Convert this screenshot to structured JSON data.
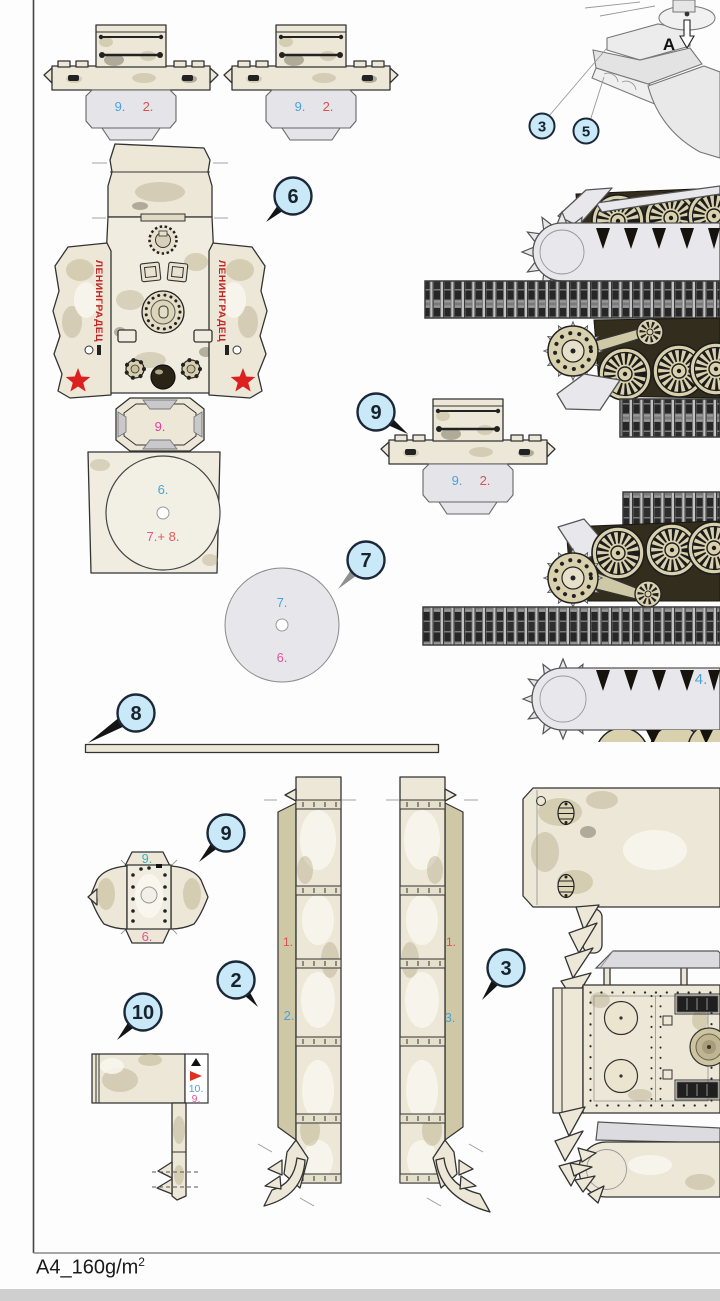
{
  "sheet": {
    "paper_spec": "A4_160g/m",
    "paper_spec_sup": "2"
  },
  "illustration": {
    "step_letter": "A",
    "callout_3": "3",
    "callout_5": "5"
  },
  "callouts": {
    "turret": "6",
    "stowage_mid": "9",
    "turret_ring_disc": "7",
    "axle_strip": "8",
    "hatch_dome": "9",
    "fender_left": "2",
    "fender_right": "3",
    "mudguard": "10"
  },
  "parts": {
    "stowage_box": {
      "label_blue": "9.",
      "label_red": "2."
    },
    "turret": {
      "neck_label": "9.",
      "base_label": "6.",
      "base_ref_a": "7.",
      "base_ref_b": "+ 8.",
      "banner": "ЛЕНИНГРАДЕЦ"
    },
    "ring_disc": {
      "label_top": "7.",
      "label_bottom": "6."
    },
    "hatch_dome": {
      "label_top": "9.",
      "label_bottom": "6."
    },
    "fender_left": {
      "side_label": "1.",
      "main_label": "2."
    },
    "fender_right": {
      "side_label": "1.",
      "main_label": "3."
    },
    "mudguard": {
      "label_blue": "10.",
      "label_pink": "9."
    },
    "track_right": {
      "label": "4."
    }
  }
}
